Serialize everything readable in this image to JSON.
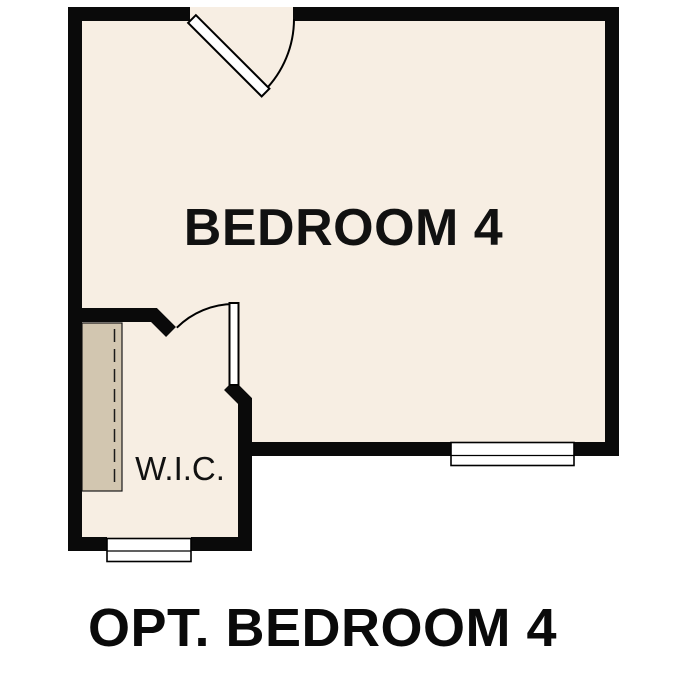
{
  "floorplan": {
    "room_label": "BEDROOM 4",
    "closet_label": "W.I.C.",
    "caption": "OPT. BEDROOM 4",
    "colors": {
      "background": "#ffffff",
      "floor": "#f7eee3",
      "wall": "#0a0a0a",
      "shelf_fill": "#d2c6b0",
      "label_text": "#111111"
    }
  }
}
